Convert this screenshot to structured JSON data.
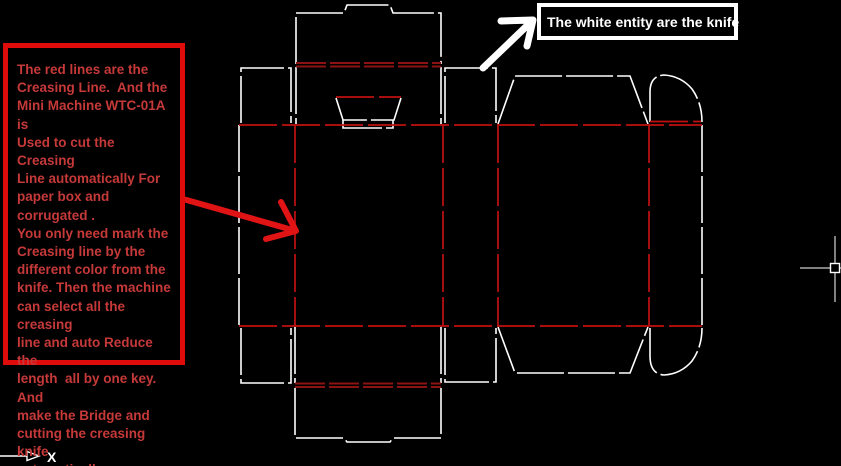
{
  "canvas": {
    "width": 841,
    "height": 466,
    "background": "#000000"
  },
  "colors": {
    "knife": "#ffffff",
    "crease": "#c01010",
    "creasedark": "#8d1212",
    "noteborder": "#e00c0c",
    "notetext": "#c63939",
    "arrowred": "#e01414",
    "labelborder": "#ffffff",
    "labeltext": "#ffffff"
  },
  "note": {
    "lines": [
      "The red lines are the",
      "Creasing Line.  And the",
      "Mini Machine WTC-01A is",
      "Used to cut the Creasing",
      "Line automatically For",
      "paper box and corrugated .",
      "You only need mark the",
      "Creasing line by the",
      "different color from the",
      "knife. Then the machine",
      "can select all the creasing",
      "line and auto Reduce the",
      "length  all by one key. And",
      "make the Bridge and",
      "cutting the creasing knife",
      "automatically."
    ]
  },
  "knife_label": {
    "text": "The white entity are the knife"
  },
  "ucs": {
    "x_label": "X"
  }
}
